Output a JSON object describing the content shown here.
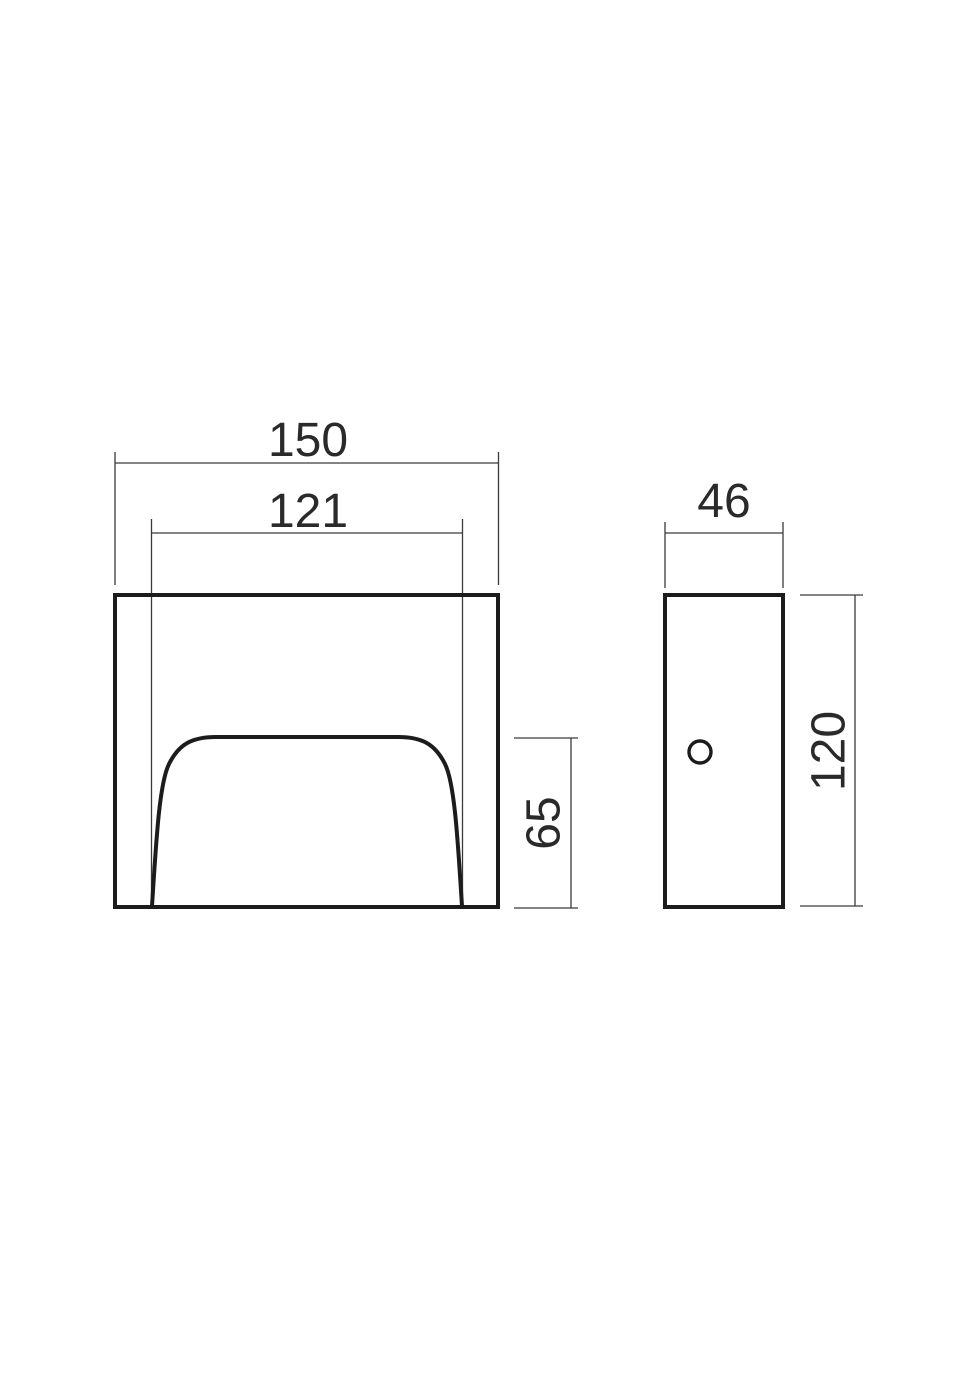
{
  "drawing": {
    "kind": "technical-dimension-drawing",
    "unit": "mm",
    "line_color": "#1c1c1c",
    "thin_line_color": "#3a3a3a",
    "background_color": "#ffffff",
    "views": {
      "front": {
        "overall_width": "150",
        "opening_width": "121",
        "opening_height": "65"
      },
      "side": {
        "depth": "46",
        "height": "120"
      }
    }
  }
}
